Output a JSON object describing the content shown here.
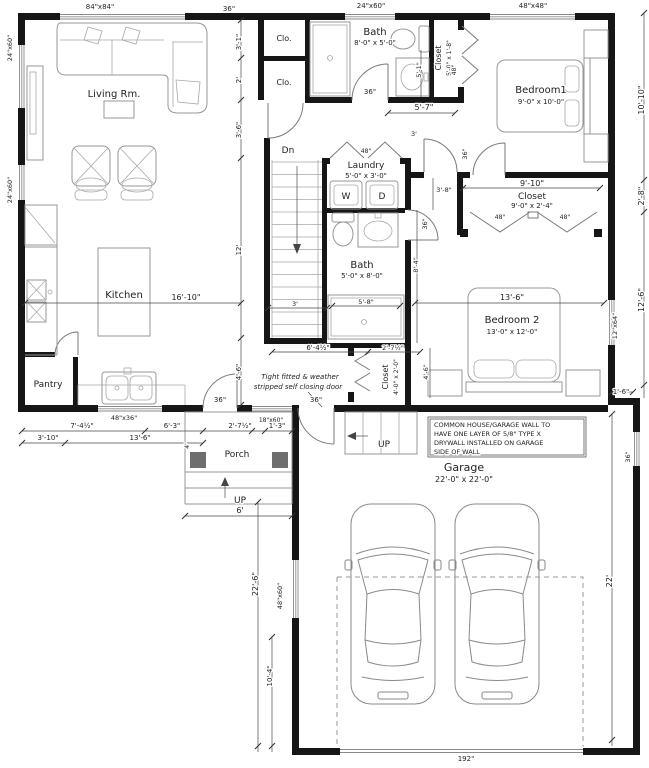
{
  "labels": {
    "living": "Living Rm.",
    "kitchen": "Kitchen",
    "pantry": "Pantry",
    "porch": "Porch",
    "garage": "Garage",
    "garage_size": "22'-0\" x 22'-0\"",
    "bedroom1": "Bedroom1",
    "bedroom1_size": "9'-0\" x 10'-0\"",
    "bedroom2": "Bedroom 2",
    "bedroom2_size": "13'-0\" x 12'-0\"",
    "bath1": "Bath",
    "bath1_size": "8'-0\" x 5'-0\"",
    "bath2": "Bath",
    "bath2_size": "5'-0\" x 8'-0\"",
    "laundry": "Laundry",
    "laundry_size": "5'-0\" x 3'-0\"",
    "closet1": "Closet",
    "closet1_size": "5'-0\" x 1'-8\"",
    "closet2": "Closet",
    "closet2_size": "9'-0\" x 2'-4\"",
    "closet3": "Closet",
    "closet3_size": "4'-0\" x 2'-0\"",
    "clo1": "Clo.",
    "clo2": "Clo.",
    "washer": "W",
    "dryer": "D",
    "dn": "Dn",
    "up_porch": "UP",
    "up_garage": "UP"
  },
  "windows": {
    "living": "84\"x84\"",
    "top_36": "36\"",
    "top_bath": "24\"x60\"",
    "bedroom1": "48\"x48\"",
    "left1": "24\"x60\"",
    "left2": "24\"x60\"",
    "kitchen": "48\"x36\"",
    "porch": "18\"x60\"",
    "bedroom2": "12\"x64\"",
    "garage_left": "48\"x60\"",
    "garage_right": "36\"",
    "garage_door": "192\""
  },
  "doors": {
    "bath1": "36\"",
    "bath2": "36\"",
    "bedroom1": "36\"",
    "kitchen": "36\"",
    "garage_entry": "36\"",
    "bifold_closet1": "48\"",
    "bifold_laundry": "48\"",
    "bifold_closet2a": "48\"",
    "bifold_closet2b": "48\""
  },
  "dims": {
    "left_chain": [
      "3'-1\"",
      "2'",
      "3'-6\"",
      "12'",
      "4'-6\""
    ],
    "right_chain": [
      "10'-10\"",
      "2'-8\"",
      "12'-6\"",
      "1'-6\""
    ],
    "kitchen_w": "16'-10\"",
    "bedroom2_w": "13'-6\"",
    "closet2_w": "9'-10\"",
    "hall_a": "5'-7\"",
    "hall_b": "5'-1\"",
    "hall_c": "3'",
    "hall_d": "3'-8\"",
    "hall_e": "8'-4\"",
    "stair_w": "3'",
    "shower": "5'-8\"",
    "hall_f": "6'-4½\"",
    "closet3_w": "2'-7½\"",
    "closet3_s": "4'-6\"",
    "bottom_row1": [
      "7'-4½\"",
      "6'-3\"",
      "2'-7½\"",
      "1'-3\""
    ],
    "bottom_row2": [
      "3'-10\"",
      "13'-6\"",
      "4'"
    ],
    "porch_w": "6'",
    "garage_left1": "22'-6\"",
    "garage_left2": "10'-4\"",
    "garage_h": "22'"
  },
  "notes": {
    "garage_wall": [
      "COMMON HOUSE/GARAGE WALL TO",
      "HAVE ONE LAYER OF 5/8\" TYPE X",
      "DRYWALL INSTALLED ON GARAGE",
      "SIDE OF WALL"
    ],
    "door": [
      "Tight fitted & weather",
      "stripped self closing door"
    ]
  }
}
